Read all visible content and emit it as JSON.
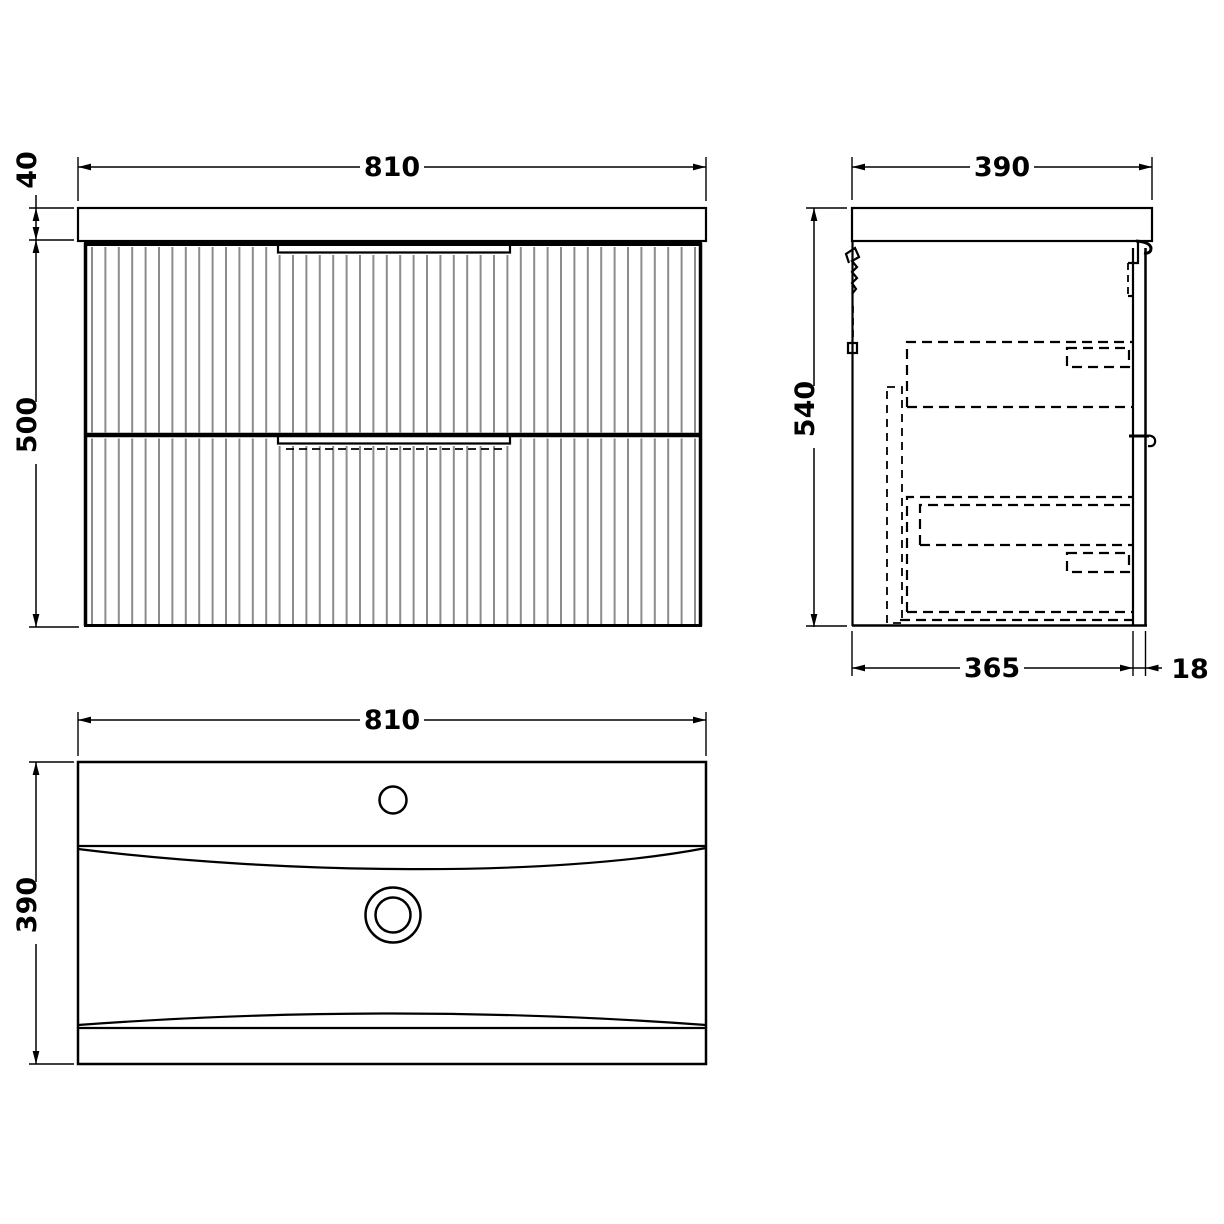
{
  "drawing": {
    "views": {
      "front": {
        "width_label": "810",
        "worktop_height_label": "40",
        "body_height_label": "500"
      },
      "side": {
        "overall_depth_label": "390",
        "overall_height_label": "540",
        "body_depth_label": "365",
        "front_panel_thickness_label": "18"
      },
      "plan": {
        "width_label": "810",
        "depth_label": "390"
      }
    },
    "colors": {
      "line": "#000000",
      "flute": "#8c8c8c",
      "background": "#ffffff"
    }
  }
}
